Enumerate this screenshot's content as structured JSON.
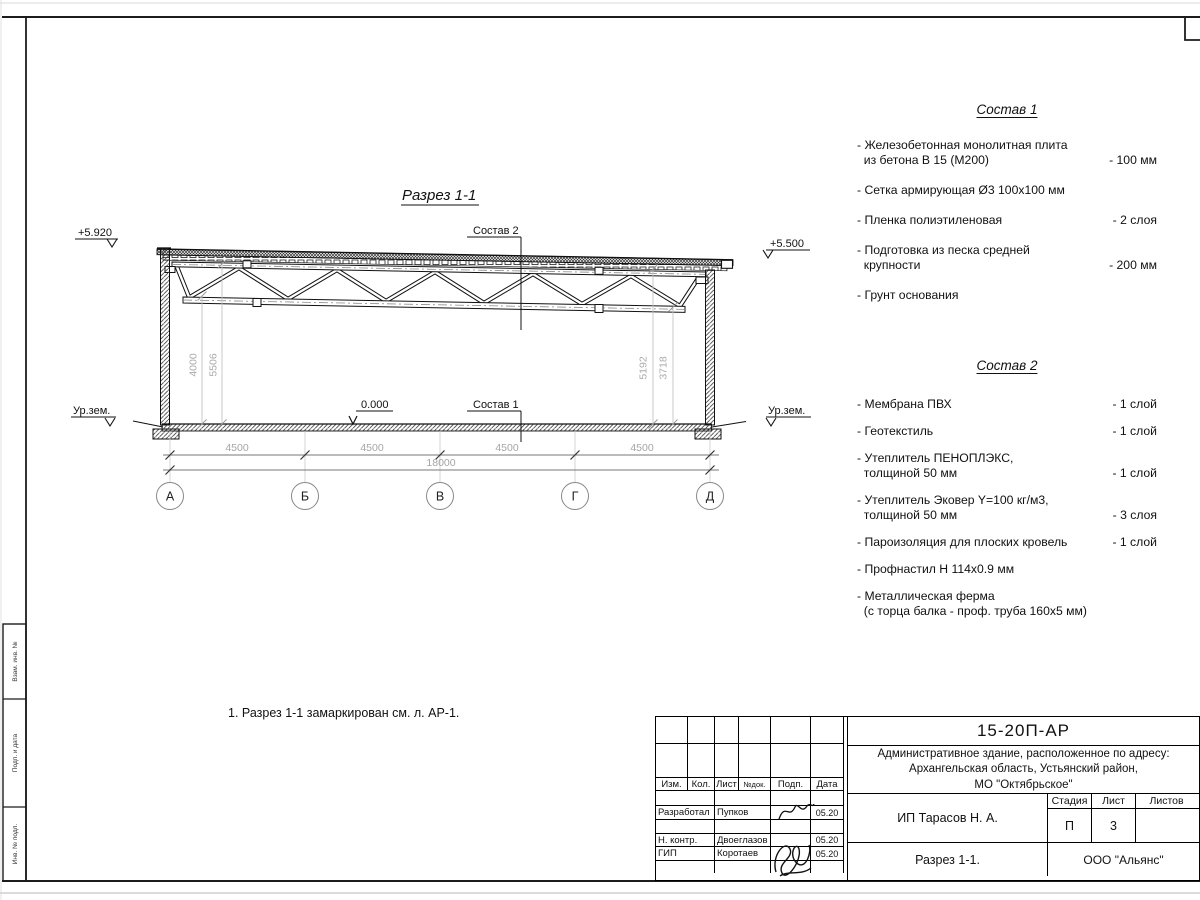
{
  "drawing": {
    "title": "Разрез 1-1",
    "elev_left": "+5.920",
    "elev_right": "+5.500",
    "elev_zero": "0.000",
    "ground_left": "Ур.зем.",
    "ground_right": "Ур.зем.",
    "leader_top": "Состав 2",
    "leader_bottom": "Состав 1",
    "bays": [
      "4500",
      "4500",
      "4500",
      "4500"
    ],
    "total": "18000",
    "vdims_left": [
      "4000",
      "5506"
    ],
    "vdims_right": [
      "5192",
      "3718"
    ],
    "axes": [
      "А",
      "Б",
      "В",
      "Г",
      "Д"
    ]
  },
  "sostav1": {
    "title": "Состав 1",
    "items": [
      {
        "name": "- Железобетонная  монолитная плита\n  из бетона В 15 (М200)",
        "value": "- 100 мм"
      },
      {
        "name": "- Сетка армирующая Ø3 100х100 мм",
        "value": ""
      },
      {
        "name": "- Пленка полиэтиленовая",
        "value": "-  2 слоя"
      },
      {
        "name": "- Подготовка из песка средней\n  крупности",
        "value": "- 200 мм"
      },
      {
        "name": "- Грунт основания",
        "value": ""
      }
    ]
  },
  "sostav2": {
    "title": "Состав 2",
    "items": [
      {
        "name": "- Мембрана ПВХ",
        "value": "- 1 слой"
      },
      {
        "name": "- Геотекстиль",
        "value": "- 1 слой"
      },
      {
        "name": "- Утеплитель ПЕНОПЛЭКС,\n  толщиной 50 мм",
        "value": "- 1 слой"
      },
      {
        "name": "- Утеплитель Эковер Y=100 кг/м3,\n  толщиной 50 мм",
        "value": "- 3 слоя"
      },
      {
        "name": "- Пароизоляция для плоских кровель",
        "value": "- 1 слой"
      },
      {
        "name": "- Профнастил Н 114х0.9 мм",
        "value": ""
      },
      {
        "name": "- Металлическая ферма\n  (с торца балка - проф. труба 160х5 мм)",
        "value": ""
      }
    ]
  },
  "note": "1. Разрез 1-1 замаркирован см. л. АР-1.",
  "titleblock": {
    "doc_number": "15-20П-АР",
    "project": "Административное здание, расположенное по адресу:\nАрхангельская область, Устьянский район,\nМО \"Октябрьское\"",
    "cols": {
      "izm": "Изм.",
      "kol": "Кол.",
      "list": "Лист",
      "ndok": "№док.",
      "podp": "Подп.",
      "data": "Дата"
    },
    "rows": [
      {
        "role": "Разработал",
        "name": "Пупков",
        "date": "05.20"
      },
      {
        "role": "Н. контр.",
        "name": "Двоеглазов",
        "date": "05.20"
      },
      {
        "role": "ГИП",
        "name": "Коротаев",
        "date": "05.20"
      }
    ],
    "client": "ИП Тарасов Н. А.",
    "stage_label": "Стадия",
    "sheet_label": "Лист",
    "sheets_label": "Листов",
    "stage": "П",
    "sheet": "3",
    "sheets": "",
    "sheet_title": "Разрез 1-1.",
    "company": "ООО \"Альянс\""
  },
  "margin": {
    "labels": [
      "Взам. инв. №",
      "Подп. и дата",
      "Инв. № подл."
    ]
  }
}
